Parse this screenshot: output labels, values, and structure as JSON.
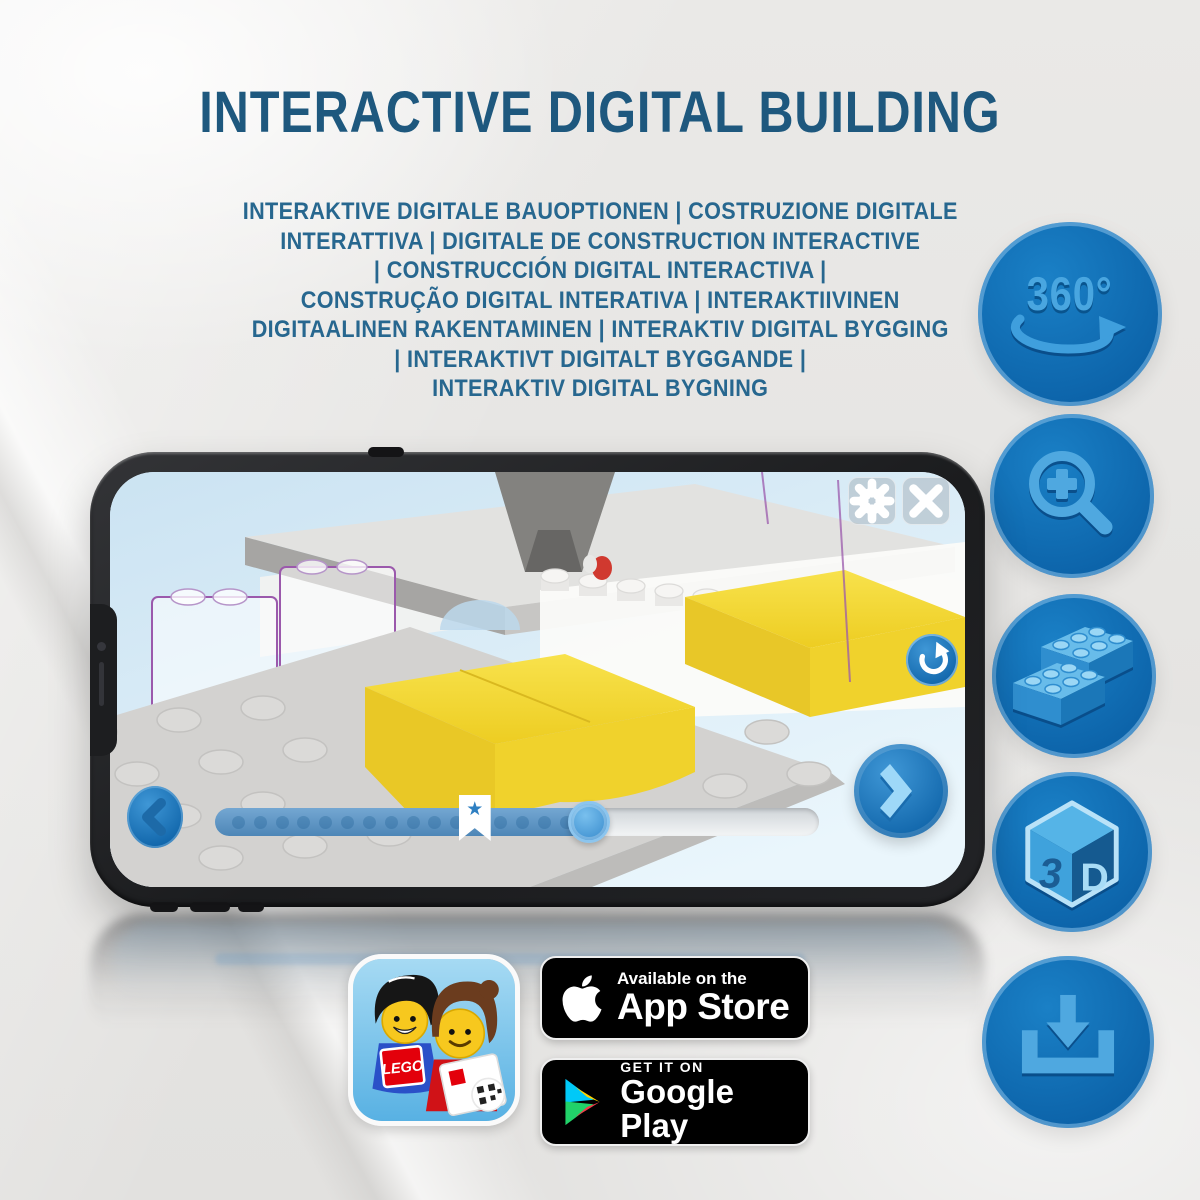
{
  "title": "INTERACTIVE DIGITAL BUILDING",
  "subtitle": {
    "lines": [
      "INTERAKTIVE DIGITALE BAUOPTIONEN | COSTRUZIONE DIGITALE",
      "INTERATTIVA | DIGITALE DE CONSTRUCTION INTERACTIVE",
      "| CONSTRUCCIÓN DIGITAL INTERACTIVA |",
      "CONSTRUÇÃO DIGITAL INTERATIVA | INTERAKTIIVINEN",
      "DIGITAALINEN RAKENTAMINEN | INTERAKTIV DIGITAL BYGGING",
      "| INTERAKTIVT DIGITALT BYGGANDE |",
      "INTERAKTIV DIGITAL BYGNING"
    ]
  },
  "features": {
    "rotate_360": {
      "label": "360°"
    },
    "cube_3d": {
      "left": "3",
      "right": "D"
    }
  },
  "phone": {
    "slider": {
      "progress_pct": 62,
      "bookmark_pct": 43,
      "dot_count": 16
    }
  },
  "badges": {
    "lego_app": {
      "logo": "LEGO"
    },
    "app_store": {
      "tagline": "Available on the",
      "name": "App Store"
    },
    "google_play": {
      "tagline": "GET IT ON",
      "name": "Google Play"
    }
  },
  "colors": {
    "title_blue": "#1e587e",
    "subtitle_blue": "#27678f",
    "circle_blue": "#0c63a9",
    "icon_light_blue": "#4fa8e0",
    "brick_yellow": "#f3d835",
    "ghost_outline_purple": "#9b59ac",
    "screen_sky_blue": "#dff0fb"
  }
}
